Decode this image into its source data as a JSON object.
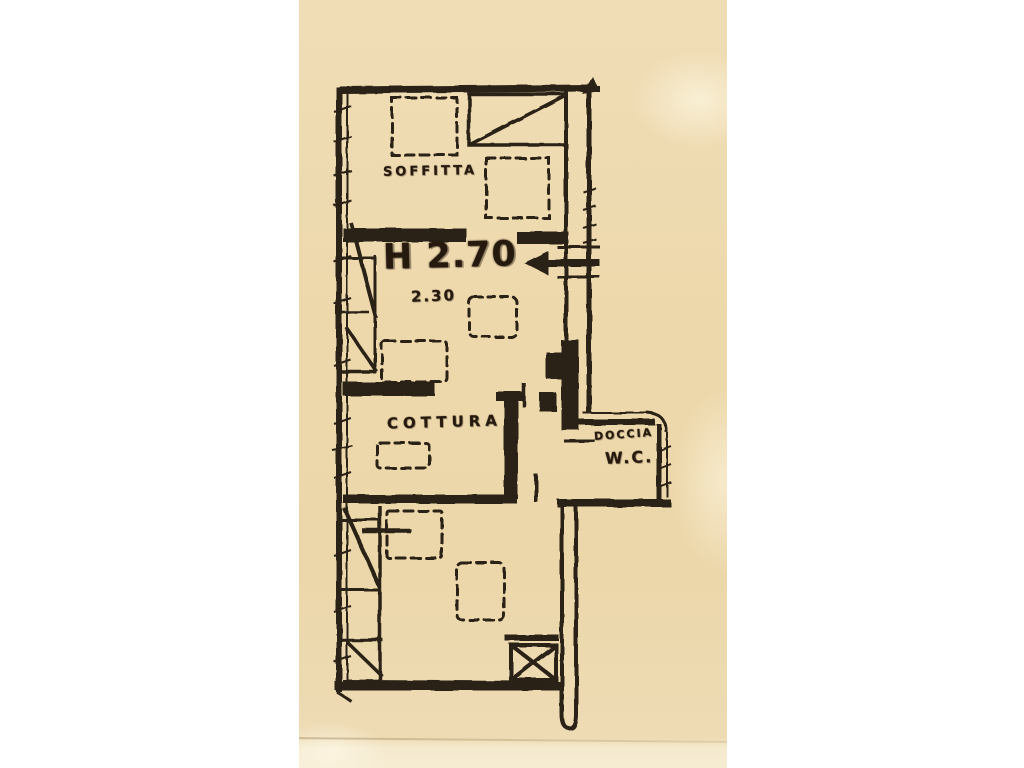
{
  "page": {
    "background": "#ffffff"
  },
  "paper": {
    "background": "#edd9ae",
    "ink": "#2b2014",
    "description": "Scanned hand-drawn Italian apartment floor plan on tan paper"
  },
  "labels": {
    "soffitta": "SOFFITTA",
    "height_main": "H 2.70",
    "height_sub": "2.30",
    "cottura": "COTTURA",
    "doccia": "DOCCIA",
    "wc": "W.C."
  },
  "symbols": [
    "attic-hatch-diagonal-box",
    "entrance-arrow-left",
    "stair-run-upper",
    "stair-run-lower",
    "shaft-x-crossed-box",
    "dashed-furniture-outlines",
    "double-line-exterior-walls"
  ]
}
